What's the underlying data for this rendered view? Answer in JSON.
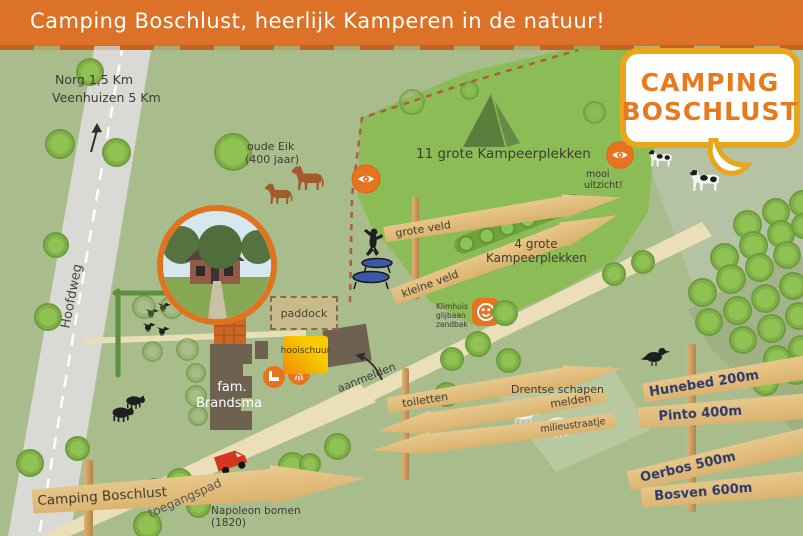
{
  "banner": {
    "title": "Camping Boschlust, heerlijk Kamperen in de natuur!"
  },
  "logo": {
    "line1": "CAMPING",
    "line2": "BOSCHLUST"
  },
  "top_left": {
    "dest1": "Norg 1,5 Km",
    "dest2": "Veenhuizen 5 Km"
  },
  "road": {
    "name": "Hoofdweg"
  },
  "path": {
    "name": "toegangspad"
  },
  "oak": {
    "line1": "oude Eik",
    "line2": "(400 jaar)"
  },
  "fields": {
    "large": "11 grote Kampeerplekken",
    "small_line1": "4 grote",
    "small_line2": "Kampeerplekken"
  },
  "viewpoint": {
    "line1": "mooi",
    "line2": "uitzicht!"
  },
  "playground": {
    "line1": "Klimhuis",
    "line2": "glijbaan",
    "line3": "zandbak"
  },
  "farm": {
    "paddock": "paddock",
    "hay_barn": "hooischuur",
    "family_line1": "fam.",
    "family_line2": "Brandsma",
    "register": "aanmelden"
  },
  "sheep": {
    "label": "Drentse schapen"
  },
  "napoleon": {
    "line1": "Napoleon bomen",
    "line2": "(1820)"
  },
  "signs": {
    "field": [
      {
        "label": "grote veld"
      },
      {
        "label": "kleine veld"
      }
    ],
    "facilities": [
      {
        "label": "toiletten"
      },
      {
        "label": "melden"
      },
      {
        "label": "milieustraatje"
      }
    ],
    "distances": [
      {
        "label": "Hunebed 200m"
      },
      {
        "label": "Pinto 400m"
      },
      {
        "label": "Oerbos 500m"
      },
      {
        "label": "Bosven 600m"
      }
    ],
    "entrance": "Camping Boschlust"
  },
  "colors": {
    "banner_orange": "#DC7128",
    "logo_orange": "#E87A1E",
    "logo_border": "#E8A61C",
    "marker_orange": "#E8731F",
    "field_green": "#8CBC55",
    "background_green": "#A9BC8C",
    "wood": "#E0BA7B",
    "sign_text_navy": "#2E3A6B",
    "dashed_border": "#B2584B"
  }
}
